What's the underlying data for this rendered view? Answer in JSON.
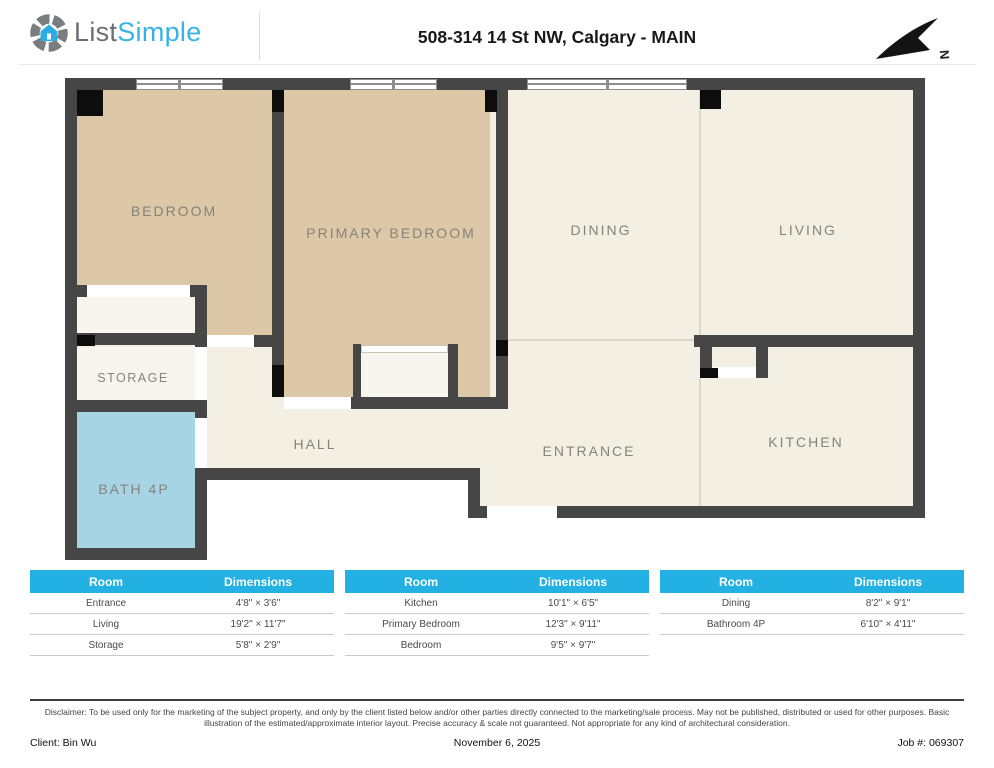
{
  "header": {
    "logo_list": "List",
    "logo_simple": "Simple",
    "title": "508-314 14 St NW, Calgary - MAIN",
    "compass": "N"
  },
  "floorplan": {
    "rooms": {
      "bedroom": "BEDROOM",
      "primary_bedroom": "PRIMARY BEDROOM",
      "dining": "DINING",
      "living": "LIVING",
      "storage": "STORAGE",
      "hall": "HALL",
      "bath": "BATH 4P",
      "entrance": "ENTRANCE",
      "kitchen": "KITCHEN"
    },
    "colors": {
      "wall": "#464646",
      "room_tan": "#dcc7a7",
      "room_cream": "#f4efe3",
      "room_white": "#f8f5ef",
      "bath_blue": "#a7d4e4",
      "table_header": "#23b0e2"
    }
  },
  "dimension_tables": [
    {
      "headers": {
        "room": "Room",
        "dimensions": "Dimensions"
      },
      "rows": [
        {
          "room": "Entrance",
          "dimensions": "4'8\" × 3'6\""
        },
        {
          "room": "Living",
          "dimensions": "19'2\" × 11'7\""
        },
        {
          "room": "Storage",
          "dimensions": "5'8\" × 2'9\""
        }
      ]
    },
    {
      "headers": {
        "room": "Room",
        "dimensions": "Dimensions"
      },
      "rows": [
        {
          "room": "Kitchen",
          "dimensions": "10'1\" × 6'5\""
        },
        {
          "room": "Primary Bedroom",
          "dimensions": "12'3\" × 9'11\""
        },
        {
          "room": "Bedroom",
          "dimensions": "9'5\" × 9'7\""
        }
      ]
    },
    {
      "headers": {
        "room": "Room",
        "dimensions": "Dimensions"
      },
      "rows": [
        {
          "room": "Dining",
          "dimensions": "8'2\" × 9'1\""
        },
        {
          "room": "Bathroom 4P",
          "dimensions": "6'10\" × 4'11\""
        }
      ]
    }
  ],
  "footer": {
    "disclaimer": "Disclaimer: To be used only for the marketing of the subject property, and only by the client listed below and/or other parties directly connected to the marketing/sale process. May not be published, distributed or used for other purposes. Basic illustration of the estimated/approximate interior layout. Precise accuracy & scale not guaranteed. Not appropriate for any kind of architectural consideration.",
    "client": "Client: Bin Wu",
    "date": "November 6, 2025",
    "job": "Job #: 069307"
  }
}
